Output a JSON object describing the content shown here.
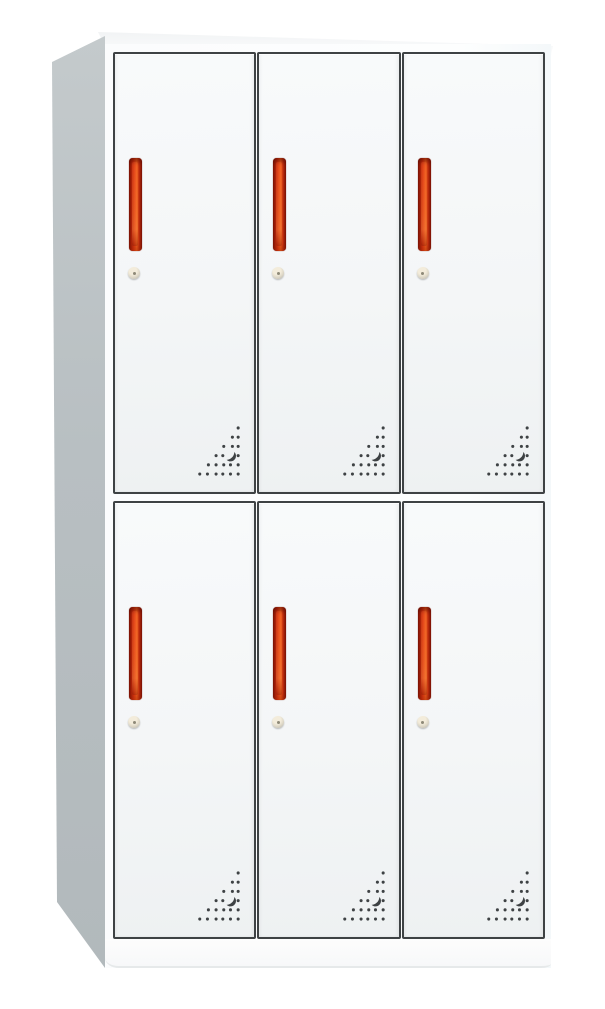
{
  "cabinet": {
    "name": "six-door-locker-cabinet",
    "rows": 2,
    "columns": 3,
    "door_count": 6,
    "doors": [
      {
        "id": "door-1",
        "row": 1,
        "col": 1
      },
      {
        "id": "door-2",
        "row": 1,
        "col": 2
      },
      {
        "id": "door-3",
        "row": 1,
        "col": 3
      },
      {
        "id": "door-4",
        "row": 2,
        "col": 1
      },
      {
        "id": "door-5",
        "row": 2,
        "col": 2
      },
      {
        "id": "door-6",
        "row": 2,
        "col": 3
      }
    ],
    "features_per_door": [
      "door-handle-icon",
      "keyhole-lock-icon",
      "vent-holes-icon"
    ],
    "vent_pattern": {
      "shape": "right-triangle",
      "dot_rows_top_to_bottom": [
        1,
        2,
        3,
        3,
        5,
        6
      ],
      "has_crescent_cutout": true
    },
    "colors": {
      "door_face": "#f4f6f7",
      "outline_dark": "#3e4244",
      "side_gray": "#b8bfc2",
      "handle_dark": "#8a1206",
      "handle_red": "#d93410",
      "handle_orange": "#ef5d1d",
      "lock_light": "#f3ecdb",
      "lock_dark": "#aeaca2"
    }
  }
}
